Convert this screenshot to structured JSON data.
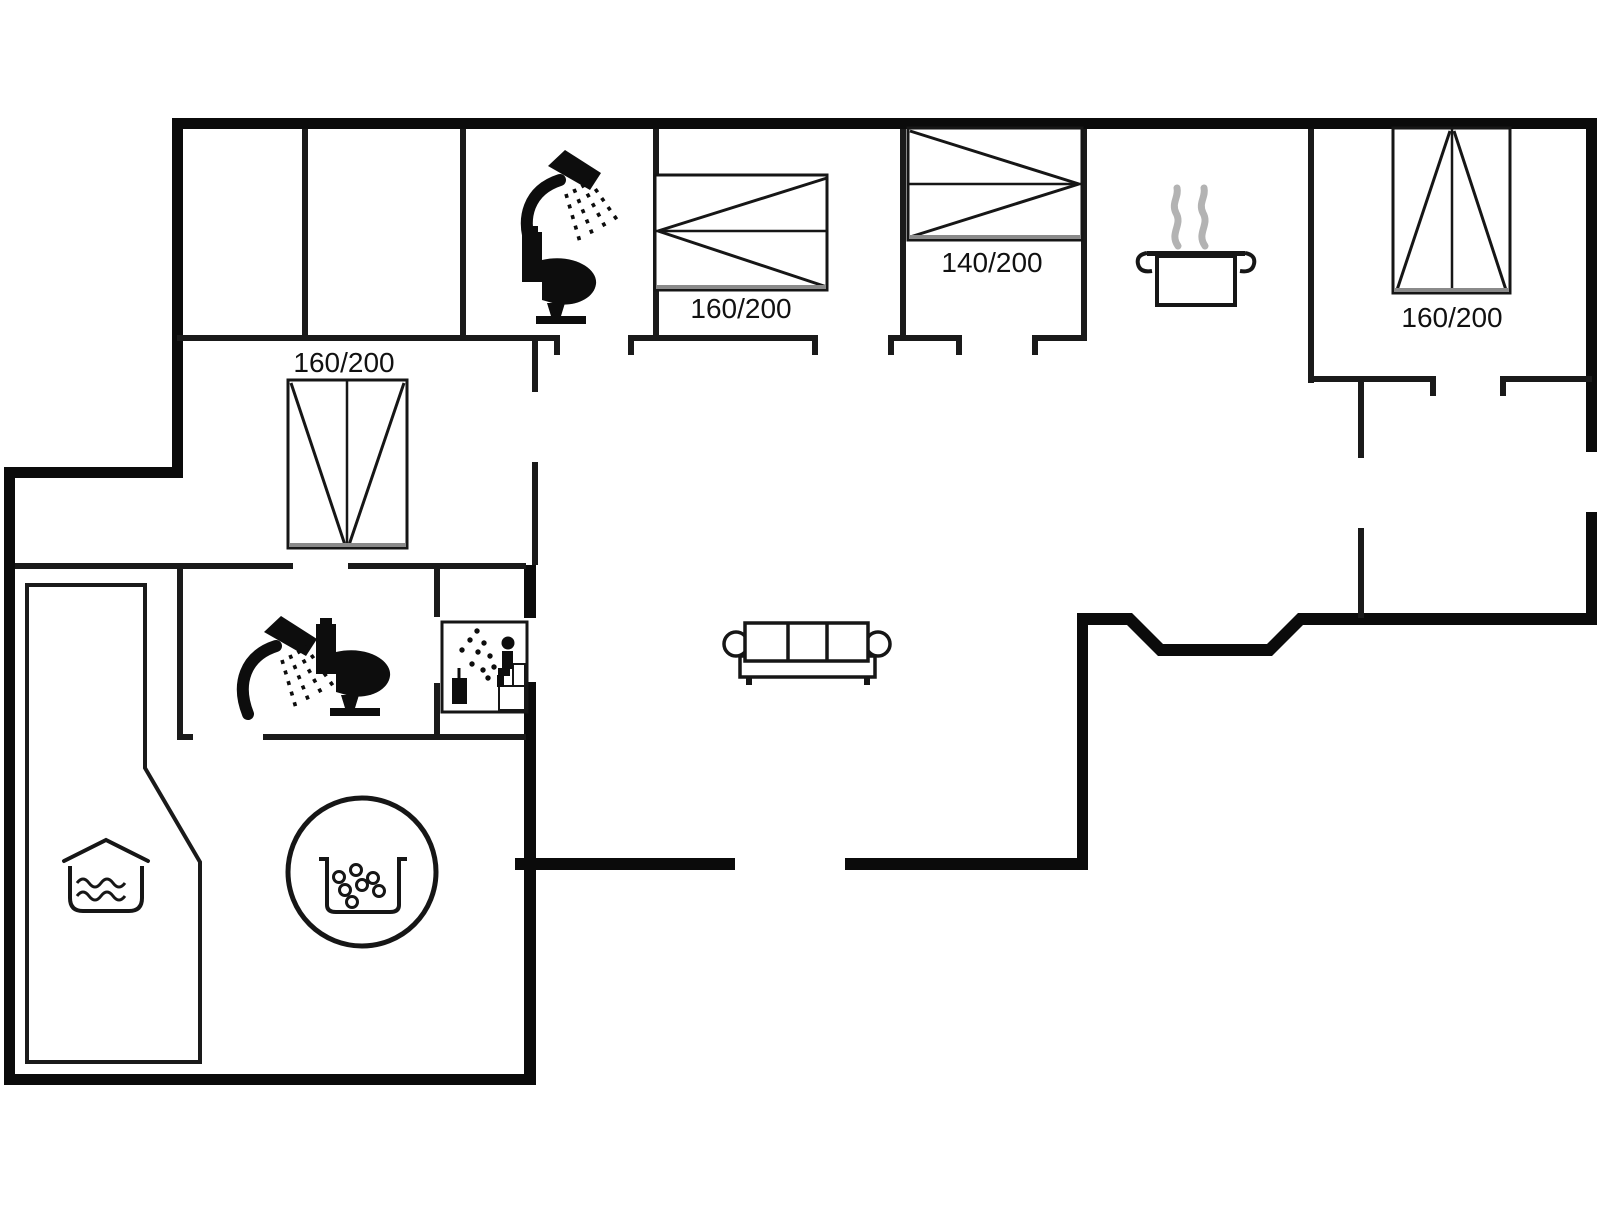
{
  "plan": {
    "type": "floorplan",
    "background_color": "#ffffff",
    "wall_color": "#0b0b0b",
    "interior_wall_color": "#1a1a1a",
    "furniture_line_color": "#161616",
    "bed_foot_line_color": "#8a8a8a",
    "steam_color": "#b3b3b3",
    "beds": [
      {
        "id": "bed-top-center",
        "label": "160/200"
      },
      {
        "id": "bed-top-140",
        "label": "140/200"
      },
      {
        "id": "bed-right",
        "label": "160/200"
      },
      {
        "id": "bed-left-middle",
        "label": "160/200"
      }
    ],
    "symbols": [
      "shower-icon",
      "toilet-icon",
      "sauna-icon",
      "cooking-pot-icon",
      "sofa",
      "hot-tub-icon",
      "pool-icon"
    ]
  }
}
